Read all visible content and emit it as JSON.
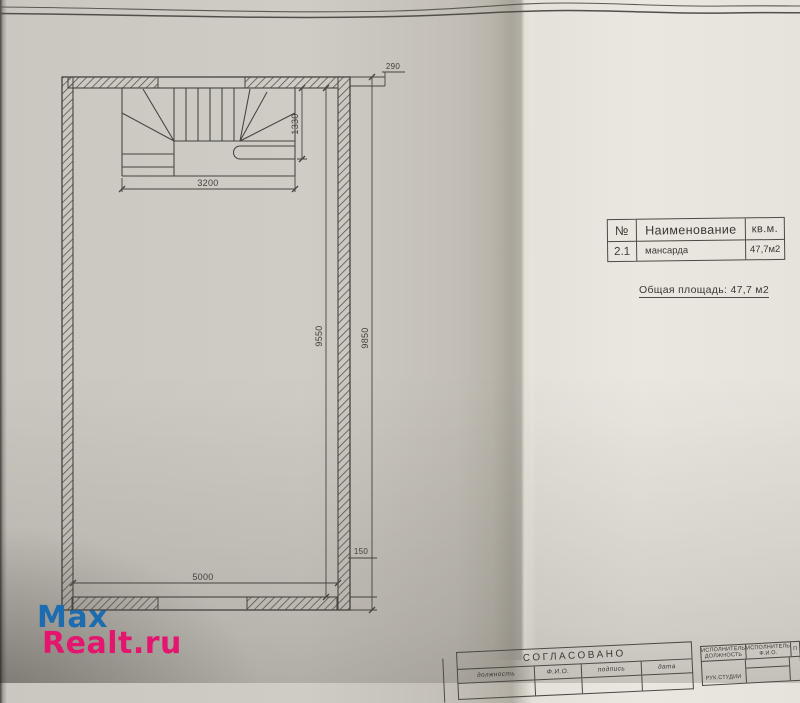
{
  "watermark": {
    "line1": "Max",
    "line2": "Realt.ru",
    "color_line1": "#1d6cb0",
    "color_line2": "#e3156f"
  },
  "plan": {
    "dims": {
      "d290": "290",
      "d1330": "1330",
      "d3200": "3200",
      "d9550": "9550",
      "d9850": "9850",
      "d150": "150",
      "d5000": "5000"
    }
  },
  "area_table": {
    "header": {
      "num": "№",
      "name": "Наименование",
      "unit": "кв.м."
    },
    "rows": [
      {
        "num": "2.1",
        "name": "мансарда",
        "area": "47,7м2"
      }
    ],
    "total": "Общая площадь: 47,7 м2"
  },
  "title_block": {
    "approved": "СОГЛАСОВАНО",
    "columns": [
      "должность",
      "Ф.И.О.",
      "подпись",
      "дата"
    ],
    "executor_role_header": "ИСПОЛНИТЕЛЬ\nДОЛЖНОСТЬ",
    "executor_name_header": "ИСПОЛНИТЕЛЬ\nФ.И.О.",
    "executor_extra_header": "П",
    "executor_role_value": "РУК.СТУДИИ"
  }
}
